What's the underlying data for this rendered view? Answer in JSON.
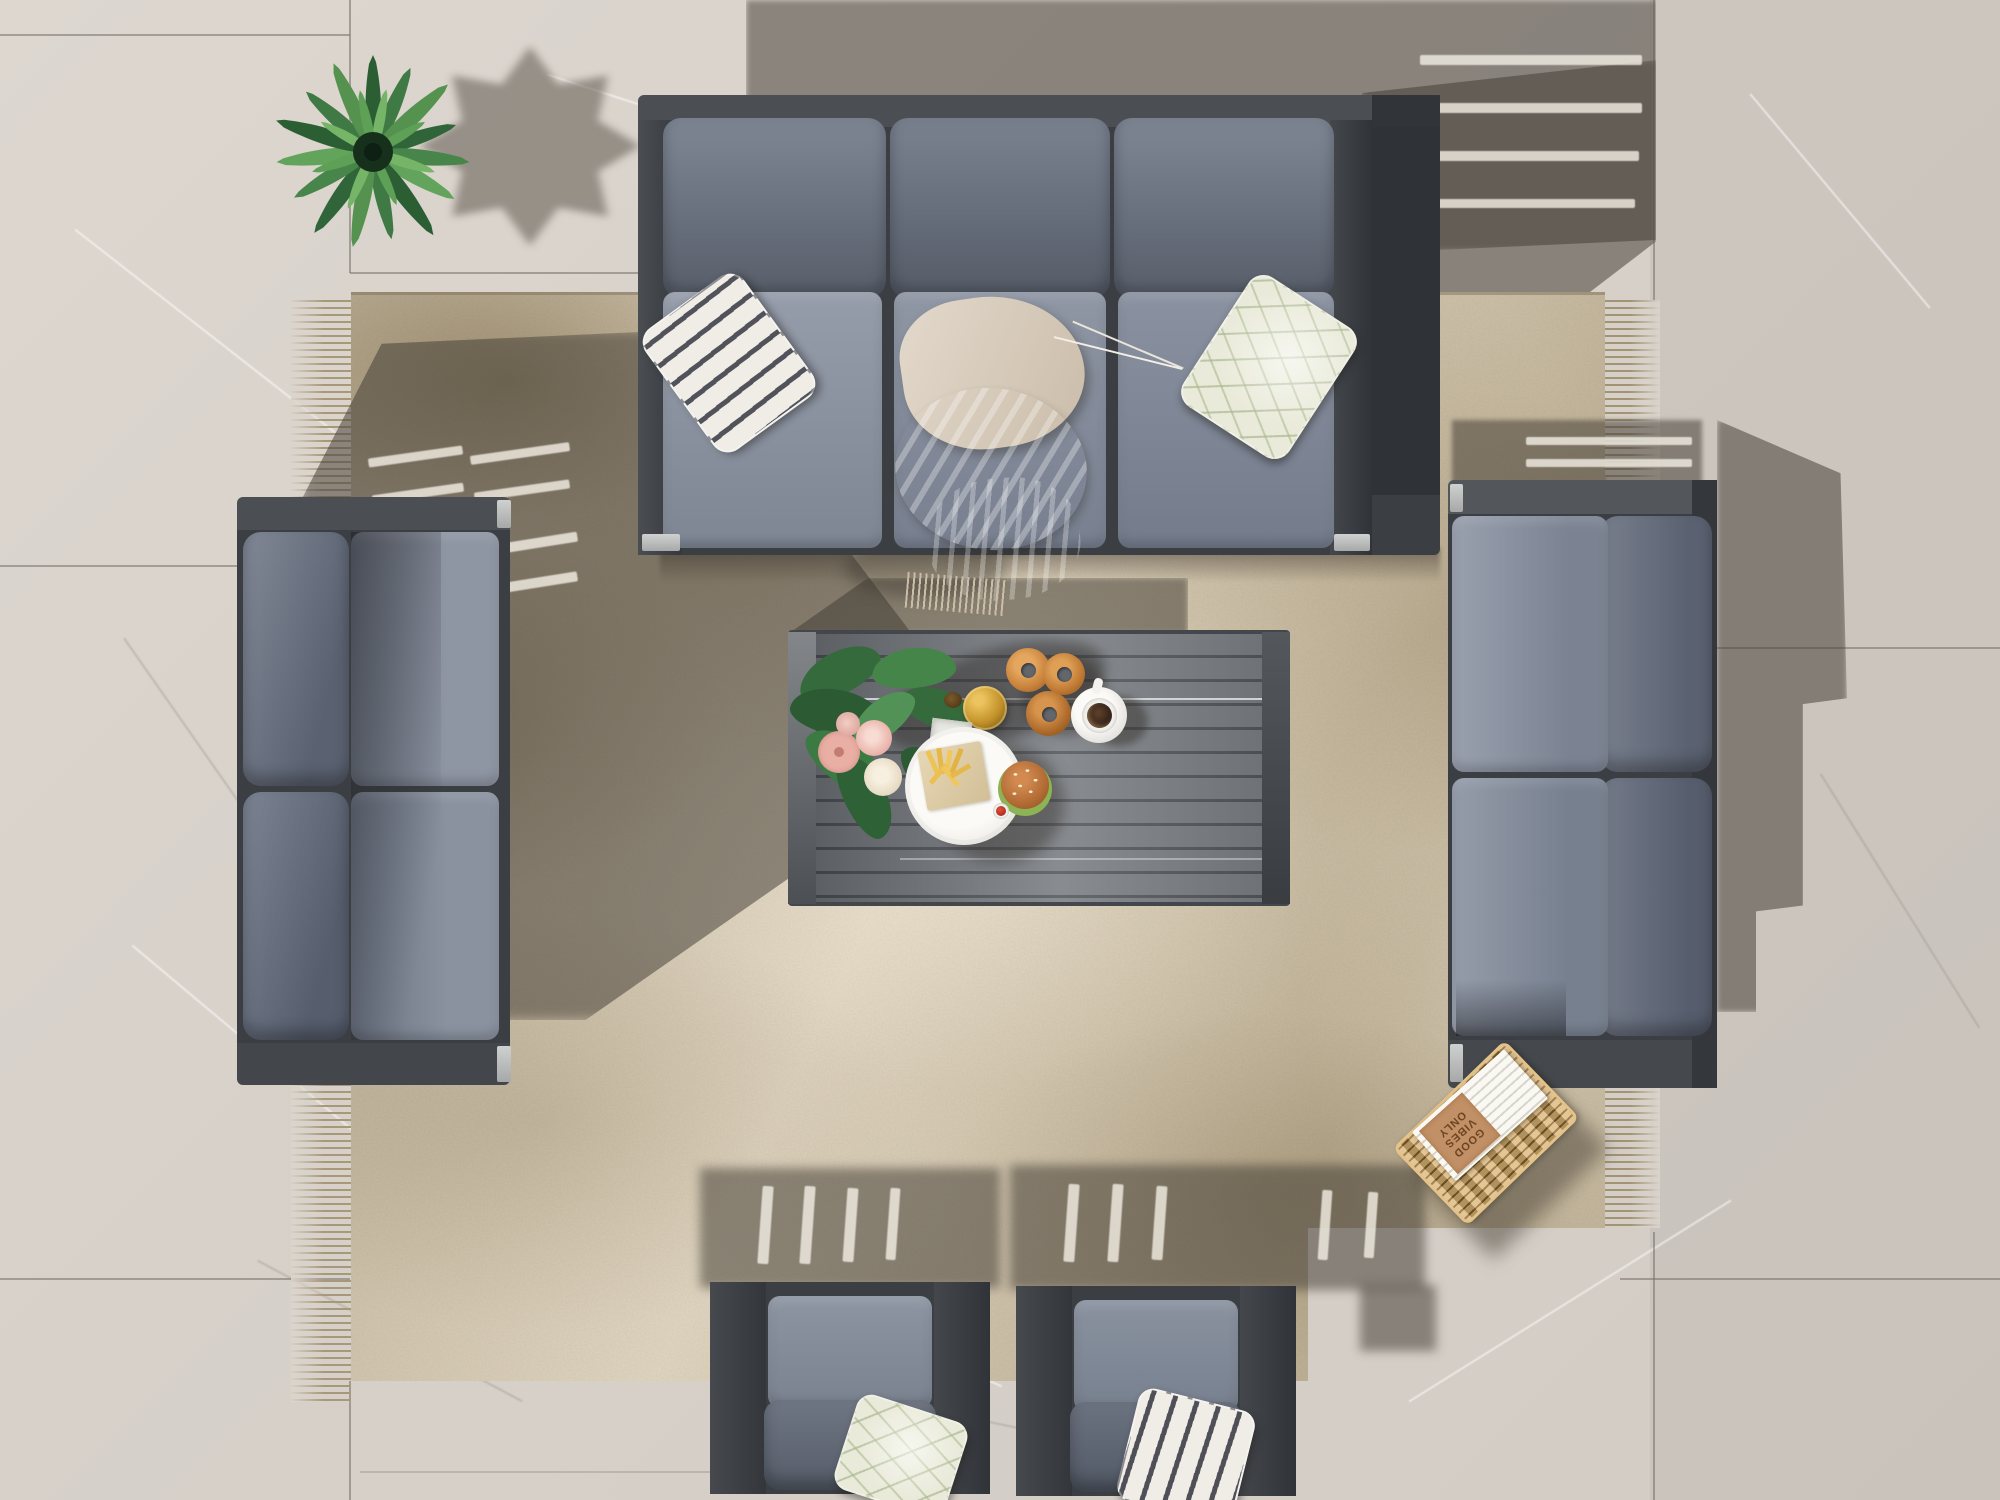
{
  "scene": {
    "description": "Top-down render: charcoal aluminium outdoor lounge set with grey cushions on a beige marbled rug over large stone patio tiles",
    "book_cover": {
      "line1": "GOOD",
      "line2": "VIBES",
      "line3": "ONLY"
    },
    "objects": [
      "potted-fan-palm",
      "three-seat-sofa",
      "left-two-seat-sofa",
      "right-two-seat-sofa",
      "armchair-left",
      "armchair-right",
      "coffee-table",
      "area-rug",
      "magazine-basket",
      "throw-blanket",
      "striped-pillow-top",
      "sage-pillow-top",
      "sage-pillow-chair",
      "striped-pillow-chair",
      "flower-bouquet",
      "donuts",
      "amber-jar",
      "square-dish",
      "coffee-cup",
      "burger-plate"
    ],
    "palette": {
      "tile": "#dad4cd",
      "grout": "#78706 6",
      "rug_base": "#cfc4ae",
      "rug_blotch": "#a08c6c",
      "frame_charcoal": "#3b3e42",
      "frame_silver": "#b8babc",
      "cushion_seat": "#8b93a1",
      "cushion_back": "#5f6673",
      "pillow_stripe": "#52525a",
      "pillow_sage": "#e9ead9",
      "blanket": "#d9cec0",
      "table_slats": "#767a7f",
      "plant_green": "#3f7a44",
      "basket_wicker": "#c59c58",
      "donut": "#c98a45",
      "coffee": "#2f2119",
      "burger_bun": "#b96f3e",
      "fries": "#eec355",
      "ketchup": "#c03327",
      "amber": "#c3922a",
      "flower_pink": "#e9b3ac",
      "flower_cream": "#ece2cf"
    }
  }
}
